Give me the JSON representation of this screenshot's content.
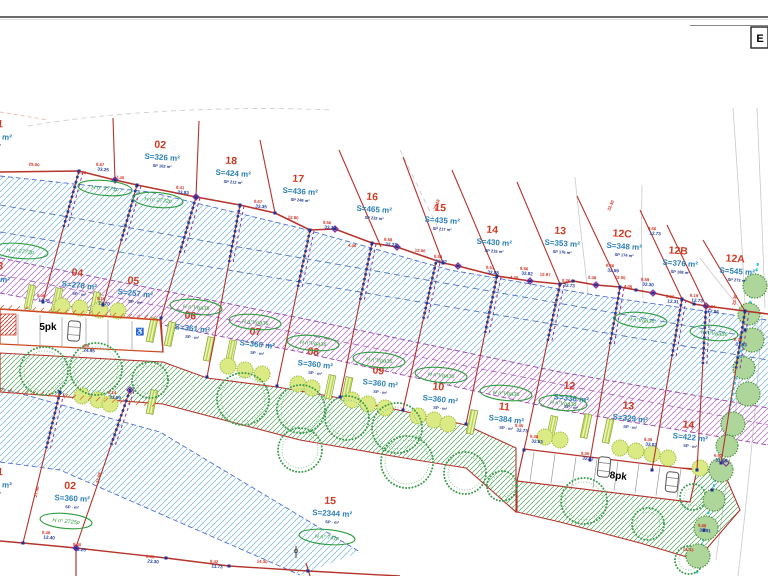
{
  "frame": {
    "corner_label": "E"
  },
  "parking": {
    "left_label": "5pk",
    "right_label": "8pk",
    "handicap_icon": "♿"
  },
  "colors": {
    "boundary_red": "#b5342c",
    "front_orange": "#cc4a22",
    "hatch_blue": "#85bedd",
    "hatch_purple": "#b678c6",
    "hatch_green": "#4ca05a",
    "node_blue": "#232f8f",
    "node_purple": "#7d2f9e",
    "dim_red": "#d03022",
    "dim_blue": "#1f3aa0",
    "plot_number_red": "#cf3a22",
    "plot_area_blue": "#2b80b8",
    "parcel_green": "#2f9e3f",
    "utility_cyan": "#2ec4d6"
  },
  "plots": [
    {
      "num": "01",
      "area": "S=331 m²",
      "sp": "SP · m²",
      "sector": "upper",
      "x": -3,
      "y": 127,
      "ax": -6
    },
    {
      "num": "02",
      "area": "S=326 m²",
      "sp": "SP 162 m²",
      "sector": "upper",
      "x": 160,
      "y": 148
    },
    {
      "num": "18",
      "area": "S=424 m²",
      "sp": "SP 212 m²",
      "sector": "upper",
      "x": 231,
      "y": 164
    },
    {
      "num": "17",
      "area": "S=436 m²",
      "sp": "SP 248 m²",
      "sector": "upper",
      "x": 298,
      "y": 182
    },
    {
      "num": "16",
      "area": "S=465 m²",
      "sp": "SP 232 m²",
      "sector": "upper",
      "x": 372,
      "y": 200
    },
    {
      "num": "15",
      "area": "S=435 m²",
      "sp": "SP 217 m²",
      "sector": "upper",
      "x": 440,
      "y": 211
    },
    {
      "num": "14",
      "area": "S=430 m²",
      "sp": "SP 215 m²",
      "sector": "upper",
      "x": 492,
      "y": 233
    },
    {
      "num": "13",
      "area": "S=353 m²",
      "sp": "SP 176 m²",
      "sector": "upper",
      "x": 560,
      "y": 234
    },
    {
      "num": "12C",
      "area": "S=348 m²",
      "sp": "SP 174 m²",
      "sector": "upper",
      "x": 622,
      "y": 237
    },
    {
      "num": "12B",
      "area": "S=376 m²",
      "sp": "SP 188 m²",
      "sector": "upper",
      "x": 678,
      "y": 254
    },
    {
      "num": "12A",
      "area": "S=545 m²",
      "sp": "SP 273 m²",
      "sector": "upper",
      "x": 735,
      "y": 262
    },
    {
      "num": "03",
      "area": "S=270 m²",
      "sp": "SP · m²",
      "sector": "middle",
      "x": -3,
      "y": 269,
      "ax": -8
    },
    {
      "num": "04",
      "area": "S=278 m²",
      "sp": "SP · m²",
      "sector": "middle",
      "x": 77,
      "y": 276
    },
    {
      "num": "05",
      "area": "S=257 m²",
      "sp": "SP · m²",
      "sector": "middle",
      "x": 133,
      "y": 284
    },
    {
      "num": "06",
      "area": "S=361 m²",
      "sp": "SP · m²",
      "sector": "middle",
      "x": 190,
      "y": 319
    },
    {
      "num": "07",
      "area": "S=360 m²",
      "sp": "SP · m²",
      "sector": "middle",
      "x": 255,
      "y": 335
    },
    {
      "num": "08",
      "area": "S=360 m²",
      "sp": "SP · m²",
      "sector": "middle",
      "x": 313,
      "y": 355
    },
    {
      "num": "09",
      "area": "S=360 m²",
      "sp": "SP · m²",
      "sector": "middle",
      "x": 378,
      "y": 374
    },
    {
      "num": "10",
      "area": "S=360 m²",
      "sp": "SP · m²",
      "sector": "middle",
      "x": 438,
      "y": 390
    },
    {
      "num": "11",
      "area": "S=384 m²",
      "sp": "SP · m²",
      "sector": "middle",
      "x": 504,
      "y": 410
    },
    {
      "num": "12",
      "area": "S=336 m²",
      "sp": "SP · m²",
      "sector": "middle",
      "x": 569,
      "y": 389
    },
    {
      "num": "13",
      "area": "S=329 m²",
      "sp": "SP · m²",
      "sector": "middle",
      "x": 628,
      "y": 409
    },
    {
      "num": "14",
      "area": "S=422 m²",
      "sp": "SP · m²",
      "sector": "middle",
      "x": 688,
      "y": 428
    },
    {
      "num": "01",
      "area": "S=331 m²",
      "sp": "SP · m²",
      "sector": "bottom",
      "x": -3,
      "y": 475,
      "ax": -6
    },
    {
      "num": "02",
      "area": "S=360 m²",
      "sp": "SP · m²",
      "sector": "bottom",
      "x": 70,
      "y": 489
    },
    {
      "num": "15",
      "area": "S=2344 m²",
      "sp": "SP · m²",
      "sector": "bottom",
      "x": 330,
      "y": 504
    }
  ],
  "parcel_refs": [
    {
      "x": 105,
      "y": 188,
      "label": "H n° 2771p",
      "rx": 27
    },
    {
      "x": 158,
      "y": 200,
      "label": "H n° 2772p",
      "rx": 25
    },
    {
      "x": 20,
      "y": 251,
      "label": "H n° 2773p",
      "rx": 28
    },
    {
      "x": 196,
      "y": 307,
      "label": "H n°Vga36",
      "rx": 26
    },
    {
      "x": 255,
      "y": 322,
      "label": "H n°Vga36",
      "rx": 26
    },
    {
      "x": 313,
      "y": 343,
      "label": "H n°Vga36",
      "rx": 26
    },
    {
      "x": 379,
      "y": 360,
      "label": "H n°Vga36",
      "rx": 26
    },
    {
      "x": 441,
      "y": 375,
      "label": "H n°Vga36",
      "rx": 26
    },
    {
      "x": 506,
      "y": 393,
      "label": "H n°Vga36",
      "rx": 26
    },
    {
      "x": 563,
      "y": 403,
      "label": "H n°Vga36",
      "rx": 24
    },
    {
      "x": 641,
      "y": 320,
      "label": "H n°Vga36",
      "rx": 26
    },
    {
      "x": 714,
      "y": 333,
      "label": "H n°Vga36",
      "rx": 24
    },
    {
      "x": 66,
      "y": 521,
      "label": "H n° 2725p",
      "rx": 26
    },
    {
      "x": 327,
      "y": 537,
      "label": "H n° 741p",
      "rx": 28
    }
  ],
  "dimensions": [
    {
      "x": 100,
      "y": 166,
      "r": "8.87",
      "b": "33.25"
    },
    {
      "x": 34,
      "y": 166,
      "r": "29.00",
      "b": ""
    },
    {
      "x": 82,
      "y": 174,
      "r": "7.26",
      "b": ""
    },
    {
      "x": 120,
      "y": 179,
      "r": "7.40",
      "b": ""
    },
    {
      "x": 180,
      "y": 189,
      "r": "8.41",
      "b": "33.83"
    },
    {
      "x": 258,
      "y": 203,
      "r": "8.67",
      "b": "33.35"
    },
    {
      "x": 293,
      "y": 219,
      "r": "12.80",
      "b": ""
    },
    {
      "x": 327,
      "y": 224,
      "r": "8.56",
      "b": "33.32"
    },
    {
      "x": 352,
      "y": 247,
      "r": "4.40",
      "b": ""
    },
    {
      "x": 388,
      "y": 241,
      "r": "8.58",
      "b": "32.23"
    },
    {
      "x": 420,
      "y": 252,
      "r": "12.06",
      "b": ""
    },
    {
      "x": 438,
      "y": 258,
      "r": "8.58",
      "b": "32.02"
    },
    {
      "x": 490,
      "y": 269,
      "r": "8.51",
      "b": "32.88"
    },
    {
      "x": 514,
      "y": 279,
      "r": "4.25",
      "b": ""
    },
    {
      "x": 545,
      "y": 276,
      "r": "12.97",
      "b": ""
    },
    {
      "x": 524,
      "y": 270,
      "r": "8.56",
      "b": "32.82"
    },
    {
      "x": 566,
      "y": 282,
      "r": "8.26",
      "b": "32.73"
    },
    {
      "x": 592,
      "y": 279,
      "r": "2.48",
      "b": ""
    },
    {
      "x": 610,
      "y": 267,
      "r": "8.56",
      "b": "32.59"
    },
    {
      "x": 645,
      "y": 281,
      "r": "8.59",
      "b": "32.30"
    },
    {
      "x": 620,
      "y": 279,
      "r": "12.05",
      "b": ""
    },
    {
      "x": 628,
      "y": 288,
      "r": "4.05",
      "b": ""
    },
    {
      "x": 670,
      "y": 298,
      "r": "8.06",
      "b": "12.31"
    },
    {
      "x": 694,
      "y": 297,
      "r": "8.19",
      "b": "12.73"
    },
    {
      "x": 710,
      "y": 308,
      "r": "11.84",
      "b": "17.86"
    },
    {
      "x": 738,
      "y": 341,
      "r": "8.76",
      "b": "31.63"
    },
    {
      "x": 652,
      "y": 230,
      "r": "8.66",
      "b": "12.73"
    },
    {
      "x": 519,
      "y": 427,
      "r": "8.45",
      "b": "32.73"
    },
    {
      "x": 534,
      "y": 438,
      "r": "8.38",
      "b": "32.63"
    },
    {
      "x": 648,
      "y": 441,
      "r": "8.39",
      "b": "33.02"
    },
    {
      "x": 718,
      "y": 457,
      "r": "6.92",
      "b": "31.63"
    },
    {
      "x": 702,
      "y": 527,
      "r": "9.88",
      "b": "31.91"
    },
    {
      "x": 688,
      "y": 551,
      "r": "13.43",
      "b": ""
    },
    {
      "x": 46,
      "y": 534,
      "r": "8.46",
      "b": "12.40"
    },
    {
      "x": 77,
      "y": 546,
      "r": "8.40",
      "b": "33.25"
    },
    {
      "x": 150,
      "y": 558,
      "r": "8.41",
      "b": "23.30"
    },
    {
      "x": 214,
      "y": 563,
      "r": "8.42",
      "b": "11.73"
    },
    {
      "x": 262,
      "y": 563,
      "r": "14.30",
      "b": ""
    },
    {
      "x": 86,
      "y": 347,
      "r": "4.5",
      "b": "24.95"
    },
    {
      "x": 112,
      "y": 394,
      "r": "8.14",
      "b": "33.09"
    },
    {
      "x": 41,
      "y": 297,
      "r": "8.06",
      "b": "13.75"
    },
    {
      "x": 101,
      "y": 300,
      "r": "8.16",
      "b": "13.70"
    },
    {
      "x": 585,
      "y": 455,
      "r": "8.35",
      "b": "32.07"
    }
  ],
  "line_dimensions": [
    {
      "x": 38,
      "y": 492,
      "label": "27.50",
      "rot": -78
    },
    {
      "x": 100,
      "y": 478,
      "label": "31.08",
      "rot": -76
    },
    {
      "x": 612,
      "y": 206,
      "label": "32.30",
      "rot": -68
    },
    {
      "x": 438,
      "y": 205,
      "label": "28.18",
      "rot": -70
    },
    {
      "x": 736,
      "y": 300,
      "label": "23.30",
      "rot": -80
    }
  ]
}
